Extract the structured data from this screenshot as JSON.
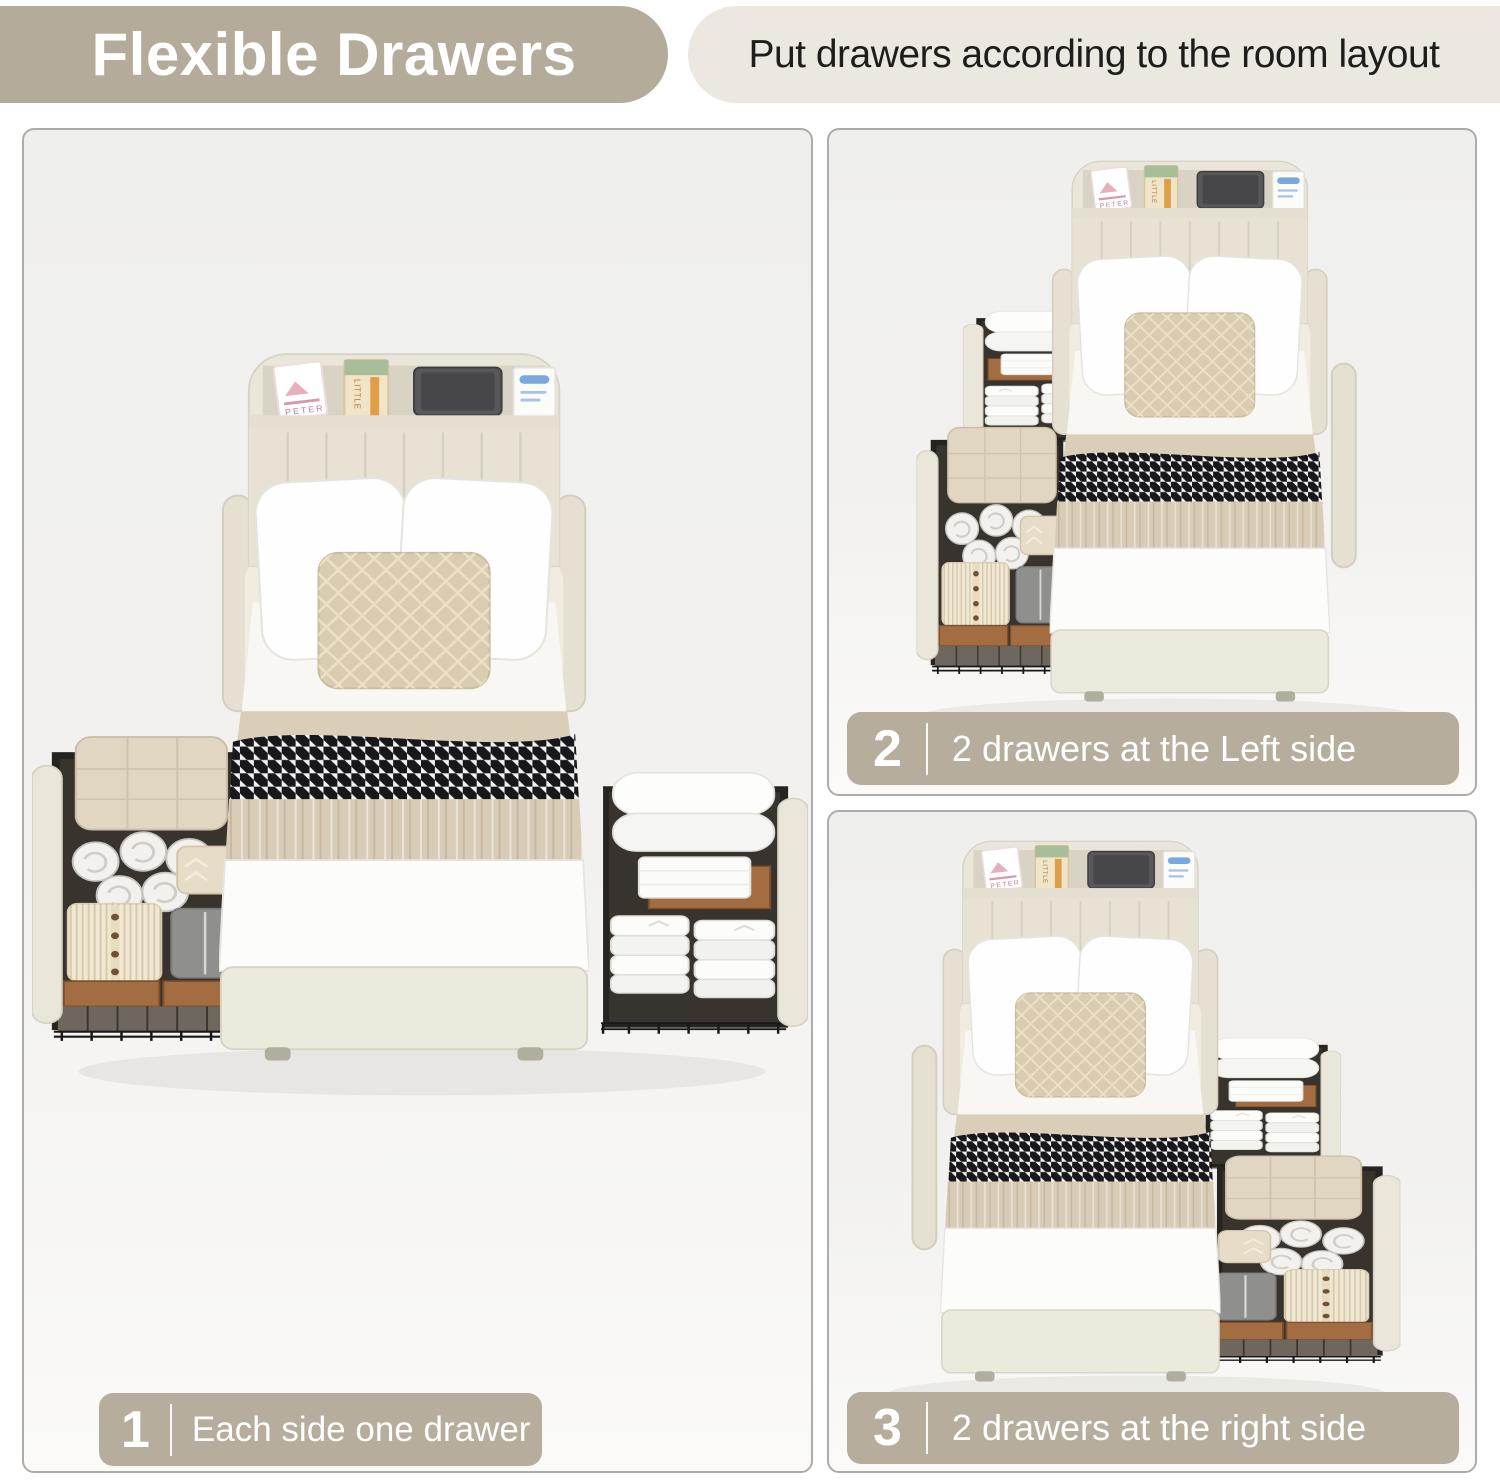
{
  "header": {
    "title": "Flexible Drawers",
    "subtitle": "Put drawers according to the room layout"
  },
  "panels": [
    {
      "number": "1",
      "caption": "Each side one drawer",
      "description": "bed with one storage drawer pulled out on each side"
    },
    {
      "number": "2",
      "caption": "2 drawers at the Left side",
      "description": "bed with two storage drawers pulled out on the left side"
    },
    {
      "number": "3",
      "caption": "2 drawers at the right side",
      "description": "bed with two storage drawers pulled out on the right side"
    }
  ],
  "decor": {
    "book1": "PETER",
    "book2": "LITTLE"
  },
  "colors": {
    "title_badge_bg": "#b5ab9b",
    "subtitle_banner_bg": "#ece8df",
    "caption_badge_bg": "#b7ad9c",
    "badge_text": "#ffffff",
    "subtitle_text": "#1e1d1b",
    "panel_bg": "#f2f1ef",
    "panel_border": "#aeaca9",
    "bed_upholstery_cream": "#eae6da",
    "quilt_beige": "#d9ccb6",
    "houndstooth_dark": "#17171c",
    "drawer_frame_black": "#262420",
    "crate_wood_brown": "#a46c41"
  }
}
